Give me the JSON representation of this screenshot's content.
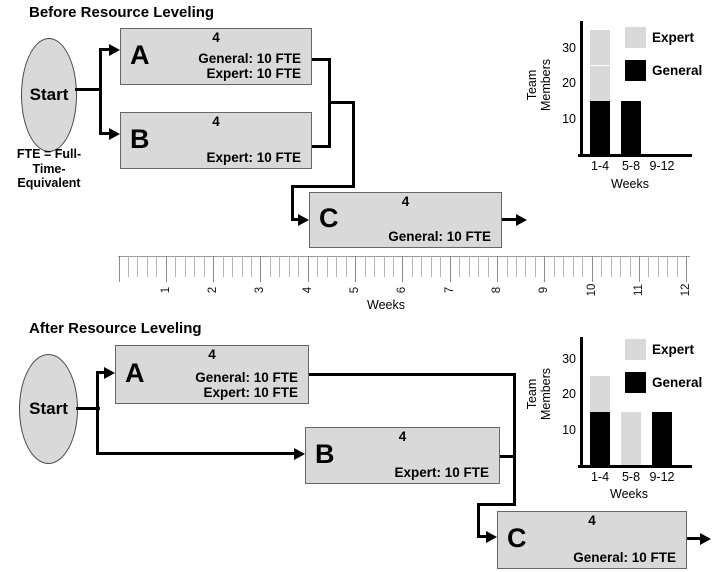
{
  "sections": {
    "before": {
      "title": "Before Resource Leveling",
      "start_label": "Start",
      "fte_note": [
        "FTE = Full-",
        "Time-",
        "Equivalent"
      ],
      "nodes": {
        "A": {
          "letter": "A",
          "duration": "4",
          "resources": [
            "General: 10 FTE",
            "Expert: 10 FTE"
          ]
        },
        "B": {
          "letter": "B",
          "duration": "4",
          "resources": [
            "Expert: 10 FTE"
          ]
        },
        "C": {
          "letter": "C",
          "duration": "4",
          "resources": [
            "General: 10 FTE"
          ]
        }
      }
    },
    "after": {
      "title": "After Resource Leveling",
      "start_label": "Start",
      "nodes": {
        "A": {
          "letter": "A",
          "duration": "4",
          "resources": [
            "General: 10 FTE",
            "Expert: 10 FTE"
          ]
        },
        "B": {
          "letter": "B",
          "duration": "4",
          "resources": [
            "Expert: 10 FTE"
          ]
        },
        "C": {
          "letter": "C",
          "duration": "4",
          "resources": [
            "General: 10 FTE"
          ]
        }
      }
    }
  },
  "timeline": {
    "axis_label": "Weeks",
    "week_numbers": [
      "1",
      "2",
      "3",
      "4",
      "5",
      "6",
      "7",
      "8",
      "9",
      "10",
      "11",
      "12"
    ]
  },
  "colors": {
    "node_fill": "#d9d9d9",
    "general_bar": "#000000",
    "expert_bar": "#d9d9d9",
    "connector": "#000000",
    "ruler_tick": "#b3b3b3"
  },
  "chart_data": [
    {
      "id": "before_resources",
      "type": "bar",
      "stacked": true,
      "section": "Before Resource Leveling",
      "categories": [
        "1-4",
        "5-8",
        "9-12"
      ],
      "xlabel": "Weeks",
      "ylabel": "Team Members",
      "yticks": [
        10,
        20,
        30
      ],
      "ylim": [
        0,
        35
      ],
      "legend_position": "right",
      "legend": [
        {
          "name": "Expert",
          "color": "#d9d9d9"
        },
        {
          "name": "General",
          "color": "#000000"
        }
      ],
      "series": [
        {
          "name": "General",
          "color": "#000000",
          "values": [
            15,
            15,
            0
          ]
        },
        {
          "name": "Expert",
          "color": "#d9d9d9",
          "values": [
            20,
            0,
            0
          ],
          "stack_segments": [
            [
              10,
              10
            ],
            [],
            []
          ]
        }
      ]
    },
    {
      "id": "after_resources",
      "type": "bar",
      "stacked": true,
      "section": "After Resource Leveling",
      "categories": [
        "1-4",
        "5-8",
        "9-12"
      ],
      "xlabel": "Weeks",
      "ylabel": "Team Members",
      "yticks": [
        10,
        20,
        30
      ],
      "ylim": [
        0,
        35
      ],
      "legend_position": "right",
      "legend": [
        {
          "name": "Expert",
          "color": "#d9d9d9"
        },
        {
          "name": "General",
          "color": "#000000"
        }
      ],
      "series": [
        {
          "name": "General",
          "color": "#000000",
          "values": [
            15,
            0,
            15
          ]
        },
        {
          "name": "Expert",
          "color": "#d9d9d9",
          "values": [
            10,
            15,
            0
          ]
        }
      ]
    }
  ]
}
